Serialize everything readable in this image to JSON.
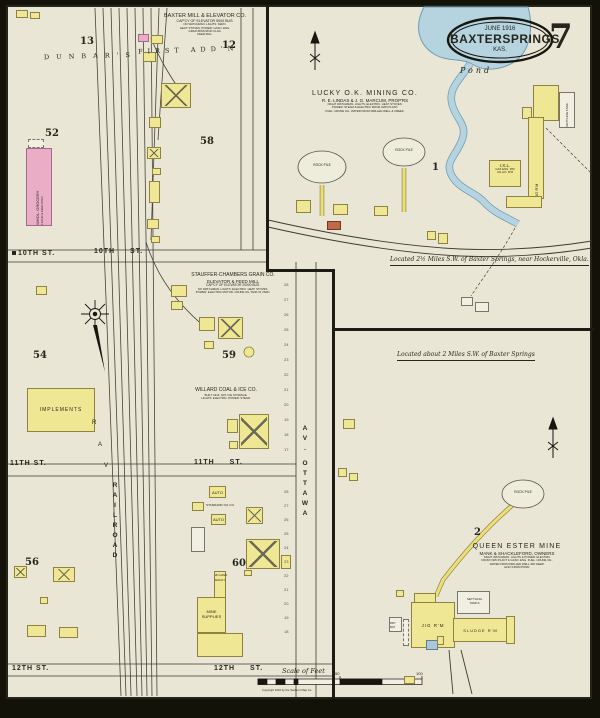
{
  "sheet": {
    "oval": {
      "date": "JUNE 1916",
      "city": "BAXTERSPRINGS",
      "state": "KAS."
    },
    "sheet_number": "7",
    "scale_label": "Scale of Feet",
    "scale_ticks": [
      "50",
      "100"
    ],
    "copyright": "Copyright 1916 by the Sanborn Map Co."
  },
  "main_map": {
    "addition_word1": "DUNBAR'S",
    "addition_word2": "FIRST ADD'N",
    "blocks": {
      "b13": "13",
      "b12": "12",
      "b52": "52",
      "b58": "58",
      "b54": "54",
      "b59": "59",
      "b56": "56",
      "b60": "60"
    },
    "streets": {
      "tenth": "10TH ST.",
      "eleventh": "11TH ST.",
      "twelfth": "12TH ST.",
      "railroad": "RAILROAD",
      "ottawa": "OTTAWA",
      "av": "AV.",
      "rr_letters": [
        "R",
        "A",
        "V"
      ]
    },
    "baxter_mill": {
      "name": "BAXTER MILL & ELEVATOR CO.",
      "capacity": "CAP'CY OF ELEVATOR 5000 BUS.",
      "notes": [
        "NO WATCHMAN. LIGHTS: KERO.",
        "HEAT: STOVES. POWER: GASO. ENG.",
        "GRAIN BINS IRON CLAD.",
        "FEED MILL."
      ]
    },
    "stauffer": {
      "name": "STAUFFER-CHAMBERS GRAIN CO.",
      "line1": "ELEVATOR & FEED MILL",
      "capacity": "CAP'CY OF ELEVATOR 20000 BUS.",
      "notes": [
        "NO WATCHMAN. LIGHTS: ELECTRIC. HEAT: STOVES.",
        "POWER: ELECTRIC MOTOR. CRUDE OIL TANK IN YARD."
      ]
    },
    "willard": {
      "name": "WILLARD COAL & ICE CO.",
      "notes": [
        "BUILT 1916. NAT. ICE STORAGE.",
        "LIGHTS: ELECTRIC. POWER: STEAM."
      ]
    },
    "grocery": {
      "line1": "WHOL. GROCERY",
      "line2": "FLOUR & FEED W'HO."
    },
    "implements_label": "IMPLEMENTS",
    "auto1": "AUTO",
    "auto2": "AUTO",
    "standard_oil": "STANDARD OIL CO.",
    "mine_supplies": {
      "note1": "2D HAND",
      "note2": "MACH'Y",
      "line1": "MINE",
      "line2": "SUPPLIES"
    },
    "lot_numbers_upper": [
      "28",
      "27",
      "26",
      "25",
      "24",
      "23",
      "22",
      "21",
      "20",
      "19",
      "18",
      "17"
    ],
    "lot_numbers_lower": [
      "28",
      "27",
      "26",
      "25",
      "24",
      "23",
      "22",
      "21",
      "20",
      "19",
      "18"
    ]
  },
  "inset_lucky": {
    "company": "LUCKY O.K. MINING CO.",
    "proprietors": "R. E. LINDAS & J. G. MARCUM, PROP'RS",
    "notes": [
      "NIGHT WATCHMAN. LIGHTS: ELECTRIC. HEAT: STOVES.",
      "POWER: STEAM & ELECTRIC FROM OWN PLANT.",
      "FUEL: CRUDE OIL. WATER FROM DRILLED WELL & CREEK."
    ],
    "pond_label": "Pond",
    "section": "1",
    "rock_pile_a": "ROCK PILE",
    "rock_pile_b": "ROCK PILE",
    "jig_label": "JIG R'M",
    "ixl": {
      "name": "I.X.L.",
      "line1": "GAS ENG. R'M",
      "line2": "OIL HO. R'M"
    },
    "settling": "SETTLING TANK",
    "location_note": "Located 2½ Miles S.W. of Baxter Springs, near Hockerville, Okla."
  },
  "inset_queen": {
    "location_note": "Located about 2 Miles S.W. of Baxter Springs",
    "section": "2",
    "name": "QUEEN ESTER MINE",
    "owners": "MANK & SHACKLEFORD, OWNERS",
    "notes": [
      "NIGHT WATCHMAN. LIGHTS & POWER: ELECTRIC",
      "FROM OWN PLANT & GASO. ENG. FUEL: CRUDE OIL.",
      "WATER FROM DRILLED WELL 300' DEEP.",
      "ALSO FROM POND."
    ],
    "rock_pile": "ROCK PILE",
    "jig": "JIG R'M",
    "sludge": "SLUDGE R'M",
    "settling_line1": "SETTLING",
    "settling_line2": "TANKS",
    "dry": "DRY R'M"
  }
}
